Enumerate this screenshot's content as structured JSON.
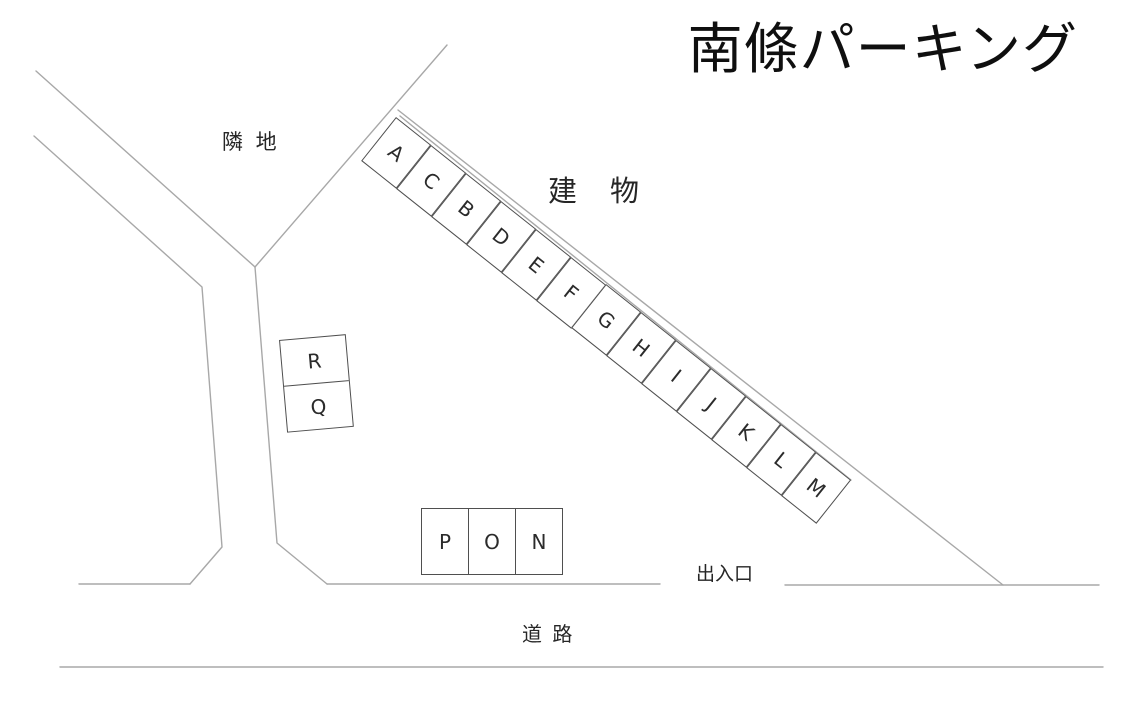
{
  "title": "南條パーキング",
  "areas": {
    "adjacent_land": "隣 地",
    "building": "建　物",
    "entrance_exit": "出入口",
    "road": "道 路"
  },
  "parking": {
    "diagonal_row": [
      "A",
      "C",
      "B",
      "D",
      "E",
      "F",
      "G",
      "H",
      "I",
      "J",
      "K",
      "L",
      "M"
    ],
    "vertical_pair": [
      "R",
      "Q"
    ],
    "horizontal_row": [
      "P",
      "O",
      "N"
    ]
  },
  "colors": {
    "outline_line": "#a8a8a8",
    "space_border": "#4f4f4f",
    "text": "#1e1e1e"
  }
}
